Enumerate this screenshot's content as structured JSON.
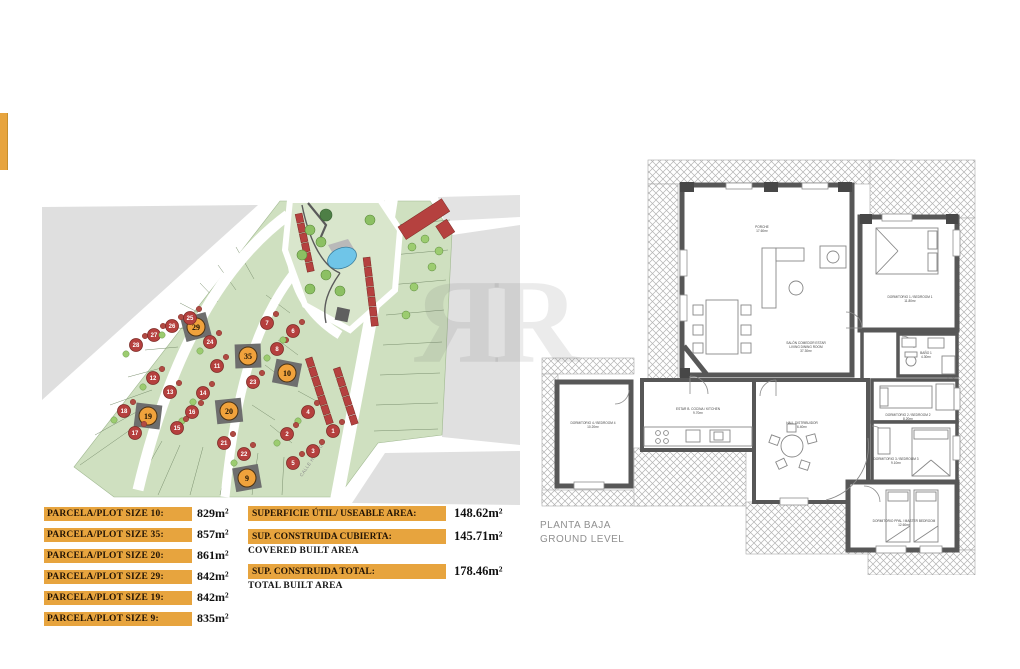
{
  "watermark": "ЯR",
  "colors": {
    "bar": "#E7A43E",
    "highlight_circle": "#F0A23C",
    "red_circle": "#B5403E",
    "dark_plot": "#6E6E6E",
    "green": "#CFE0C0",
    "park_green": "#D9E6CC",
    "gray_area": "#DFDFDF",
    "pool": "#6FC5E8",
    "wall": "#575757"
  },
  "plot_sizes": {
    "rows": [
      {
        "label": "PARCELA/PLOT SIZE 10:",
        "value": "829m²"
      },
      {
        "label": "PARCELA/PLOT SIZE 35:",
        "value": "857m²"
      },
      {
        "label": "PARCELA/PLOT SIZE 20:",
        "value": "861m²"
      },
      {
        "label": "PARCELA/PLOT SIZE 29:",
        "value": "842m²"
      },
      {
        "label": "PARCELA/PLOT SIZE 19:",
        "value": "842m²"
      },
      {
        "label": "PARCELA/PLOT SIZE 9:",
        "value": "835m²"
      }
    ]
  },
  "areas": {
    "rows": [
      {
        "label": "SUPERFICIE ÚTIL/ USEABLE AREA:",
        "sublabel": "",
        "value": "148.62m²"
      },
      {
        "label": "SUP. CONSTRUIDA CUBIERTA:",
        "sublabel": "COVERED BUILT AREA",
        "value": "145.71m²"
      },
      {
        "label": "SUP. CONSTRUIDA TOTAL:",
        "sublabel": "TOTAL BUILT AREA",
        "value": "178.46m²"
      }
    ]
  },
  "site_plan": {
    "street_label": "CALLE HINOJO",
    "plots": [
      {
        "n": "29",
        "x": 156,
        "y": 132,
        "hl": true
      },
      {
        "n": "35",
        "x": 208,
        "y": 161,
        "hl": true
      },
      {
        "n": "10",
        "x": 247,
        "y": 178,
        "hl": true
      },
      {
        "n": "20",
        "x": 189,
        "y": 216,
        "hl": true
      },
      {
        "n": "19",
        "x": 108,
        "y": 221,
        "hl": true
      },
      {
        "n": "9",
        "x": 207,
        "y": 283,
        "hl": true
      },
      {
        "n": "28",
        "x": 96,
        "y": 150,
        "hl": false
      },
      {
        "n": "27",
        "x": 114,
        "y": 140,
        "hl": false
      },
      {
        "n": "26",
        "x": 132,
        "y": 131,
        "hl": false
      },
      {
        "n": "25",
        "x": 150,
        "y": 123,
        "hl": false
      },
      {
        "n": "24",
        "x": 170,
        "y": 147,
        "hl": false
      },
      {
        "n": "23",
        "x": 213,
        "y": 187,
        "hl": false
      },
      {
        "n": "22",
        "x": 204,
        "y": 259,
        "hl": false
      },
      {
        "n": "21",
        "x": 184,
        "y": 248,
        "hl": false
      },
      {
        "n": "18",
        "x": 84,
        "y": 216,
        "hl": false
      },
      {
        "n": "17",
        "x": 95,
        "y": 238,
        "hl": false
      },
      {
        "n": "16",
        "x": 152,
        "y": 217,
        "hl": false
      },
      {
        "n": "15",
        "x": 137,
        "y": 233,
        "hl": false
      },
      {
        "n": "14",
        "x": 163,
        "y": 198,
        "hl": false
      },
      {
        "n": "13",
        "x": 130,
        "y": 197,
        "hl": false
      },
      {
        "n": "12",
        "x": 113,
        "y": 183,
        "hl": false
      },
      {
        "n": "11",
        "x": 177,
        "y": 171,
        "hl": false
      },
      {
        "n": "8",
        "x": 237,
        "y": 154,
        "hl": false
      },
      {
        "n": "7",
        "x": 227,
        "y": 128,
        "hl": false
      },
      {
        "n": "6",
        "x": 253,
        "y": 136,
        "hl": false
      },
      {
        "n": "5",
        "x": 253,
        "y": 268,
        "hl": false
      },
      {
        "n": "4",
        "x": 268,
        "y": 217,
        "hl": false
      },
      {
        "n": "3",
        "x": 273,
        "y": 256,
        "hl": false
      },
      {
        "n": "2",
        "x": 247,
        "y": 239,
        "hl": false
      },
      {
        "n": "1",
        "x": 293,
        "y": 236,
        "hl": false
      }
    ]
  },
  "floor_plan": {
    "title_line1": "PLANTA BAJA",
    "title_line2": "GROUND LEVEL",
    "room_labels": [
      {
        "x": 232,
        "y": 98,
        "lines": [
          "PORCHE",
          "17.60m²"
        ]
      },
      {
        "x": 276,
        "y": 214,
        "lines": [
          "SALÓN COMEDOR ESTAR",
          "LIVING DINING ROOM",
          "37.30m²"
        ]
      },
      {
        "x": 380,
        "y": 168,
        "lines": [
          "DORMITORIO 1 / BEDROOM 1",
          "11.80m²"
        ]
      },
      {
        "x": 168,
        "y": 280,
        "lines": [
          "ESTAR B. COCINA / KITCHEN",
          "9.70m²"
        ]
      },
      {
        "x": 63,
        "y": 294,
        "lines": [
          "DORMITORIO 4 / BEDROOM 4",
          "10.20m²"
        ]
      },
      {
        "x": 272,
        "y": 294,
        "lines": [
          "HALL DISTRIBUIDOR",
          "6.40m²"
        ]
      },
      {
        "x": 396,
        "y": 224,
        "lines": [
          "BAÑO 1",
          "4.30m²"
        ]
      },
      {
        "x": 378,
        "y": 286,
        "lines": [
          "DORMITORIO 2 / BEDROOM 2",
          "8.20m²"
        ]
      },
      {
        "x": 366,
        "y": 330,
        "lines": [
          "DORMITORIO 3 / BEDROOM 3",
          "9.10m²"
        ]
      },
      {
        "x": 374,
        "y": 392,
        "lines": [
          "DORMITORIO PPAL / MASTER BEDROOM",
          "12.60m²"
        ]
      }
    ]
  }
}
